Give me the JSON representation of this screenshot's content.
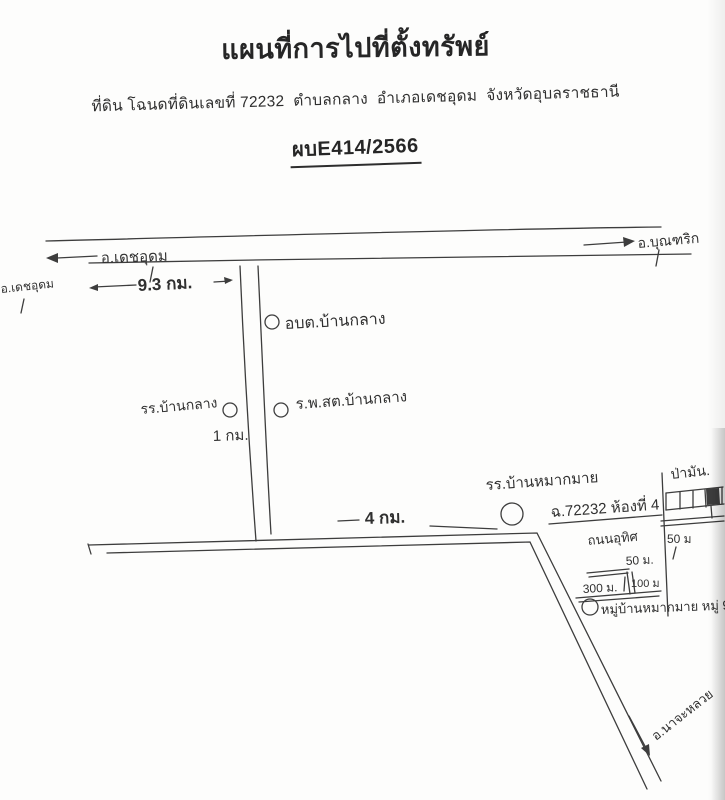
{
  "header": {
    "title": "แผนที่การไปที่ตั้งทรัพย์",
    "subtitle": "ที่ดิน โฉนดที่ดินเลขที่ 72232  ตำบลกลาง  อำเภอเดชอุดม  จังหวัดอุบลราชธานี",
    "reference": "ผบE414/2566"
  },
  "map": {
    "labels": {
      "district_west_arrow": "อ.เดชอุดม",
      "district_west_small": "อ.เดชอุดม",
      "district_east_arrow": "อ.บุณฑริก",
      "distance_main_road": "9.3 กม.",
      "sao_ban_klang": "อบต.บ้านกลาง",
      "school_ban_klang": "รร.บ้านกลาง",
      "distance_side_road": "1 กม.",
      "health_station": "ร.พ.สต.บ้านกลาง",
      "distance_bottom_road": "4 กม.",
      "school_mak_mai": "รร.บ้านหมากมาย",
      "deed_plot": "ฉ.72232 ห้องที่ 4",
      "cassava_field": "ป่ามัน.",
      "lane_name": "ถนนอุทิศ",
      "distance_50m_a": "50 ม",
      "distance_50m_b": "50 ม.",
      "distance_100m": "100 ม",
      "distance_300m": "300 ม.",
      "village": "หมู่บ้านหมากมาย หมู่ 9",
      "district_south": "อ.นาจะหลวย"
    }
  }
}
